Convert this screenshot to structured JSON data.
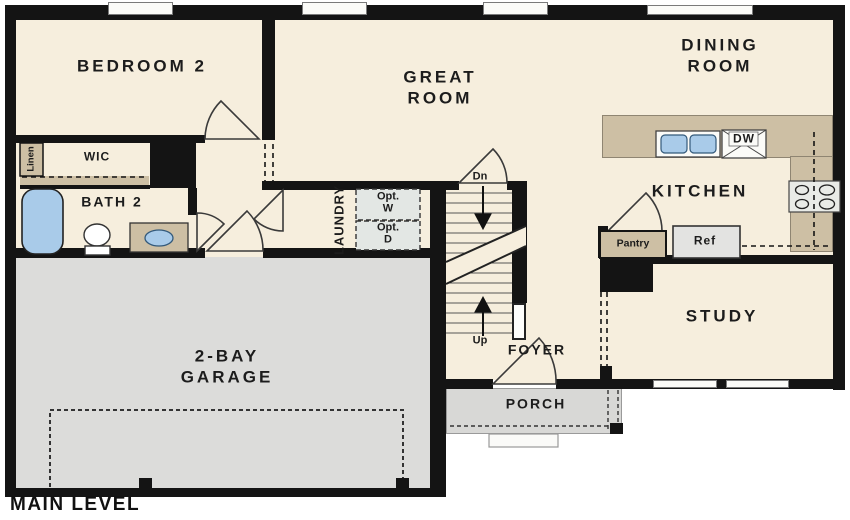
{
  "title": "MAIN LEVEL",
  "rooms": {
    "bedroom2": "BEDROOM 2",
    "great_room": {
      "line1": "GREAT",
      "line2": "ROOM"
    },
    "dining_room": {
      "line1": "DINING",
      "line2": "ROOM"
    },
    "kitchen": "KITCHEN",
    "study": "STUDY",
    "bath2": "BATH 2",
    "wic": "WIC",
    "linen": "Linen",
    "laundry": "LAUNDRY",
    "garage": {
      "line1": "2-BAY",
      "line2": "GARAGE"
    },
    "foyer": "FOYER",
    "porch": "PORCH"
  },
  "fixtures": {
    "pantry": "Pantry",
    "refrigerator": "Ref",
    "dishwasher": "DW",
    "opt_washer": {
      "line1": "Opt.",
      "line2": "W"
    },
    "opt_dryer": {
      "line1": "Opt.",
      "line2": "D"
    }
  },
  "stairs": {
    "down_label": "Dn",
    "up_label": "Up"
  },
  "colors": {
    "wall": "#141414",
    "floor": "#f6eedd",
    "counter": "#cdbfa4",
    "garage_floor": "#dcdcda",
    "porch_floor": "#d8d8d6",
    "water_fixture": "#a9cbe9",
    "appliance": "#e3e7e4",
    "text": "#1c1c1c"
  }
}
